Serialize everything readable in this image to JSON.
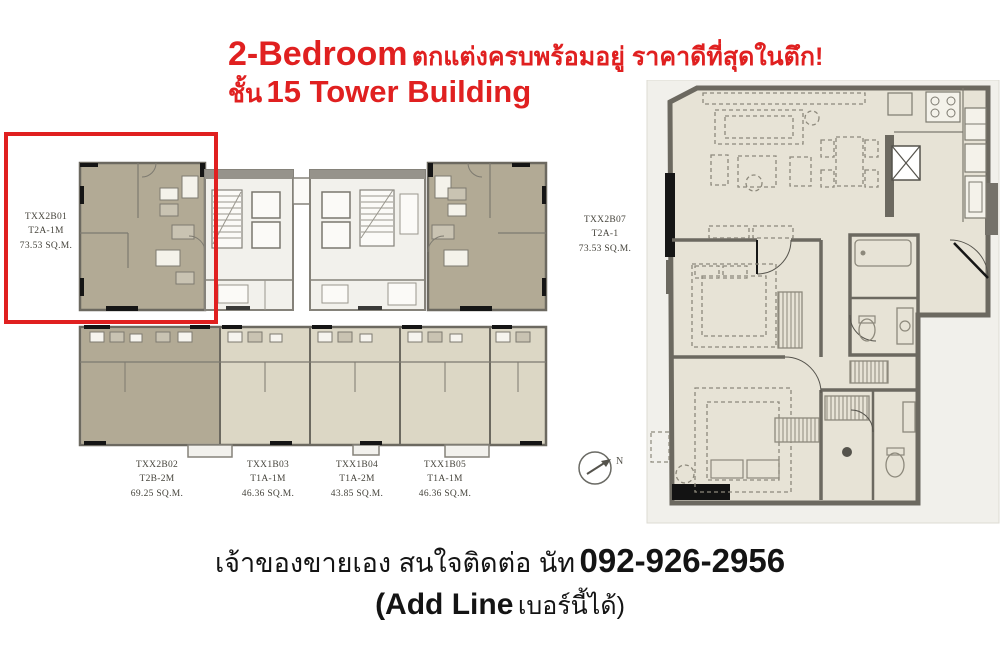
{
  "title": {
    "heading_en": "2-Bedroom",
    "heading_th": "ตกแต่งครบพร้อมอยู่ ราคาดีที่สุดในตึก!",
    "floor_th": "ชั้น",
    "floor_en": "15 Tower Building"
  },
  "floorplate": {
    "units": [
      {
        "id": "TXX2B01",
        "type": "T2A-1M",
        "area": "73.53 SQ.M."
      },
      {
        "id": "TXX2B07",
        "type": "T2A-1",
        "area": "73.53 SQ.M."
      },
      {
        "id": "TXX2B02",
        "type": "T2B-2M",
        "area": "69.25 SQ.M."
      },
      {
        "id": "TXX1B03",
        "type": "T1A-1M",
        "area": "46.36 SQ.M."
      },
      {
        "id": "TXX1B04",
        "type": "T1A-2M",
        "area": "43.85 SQ.M."
      },
      {
        "id": "TXX1B05",
        "type": "T1A-1M",
        "area": "46.36 SQ.M."
      }
    ],
    "compass": "N"
  },
  "contact": {
    "line1_th": "เจ้าของขายเอง สนใจติดต่อ นัท",
    "phone": "092-926-2956",
    "line2_en": "(Add Line",
    "line2_th": "เบอร์นี้ได้)"
  },
  "colors": {
    "accent_red": "#e02020",
    "unit_tan": "#b2aa95",
    "unit_light": "#dcd7c5",
    "wall_gray": "#6c6960",
    "floor_beige": "#e7e3d6"
  }
}
